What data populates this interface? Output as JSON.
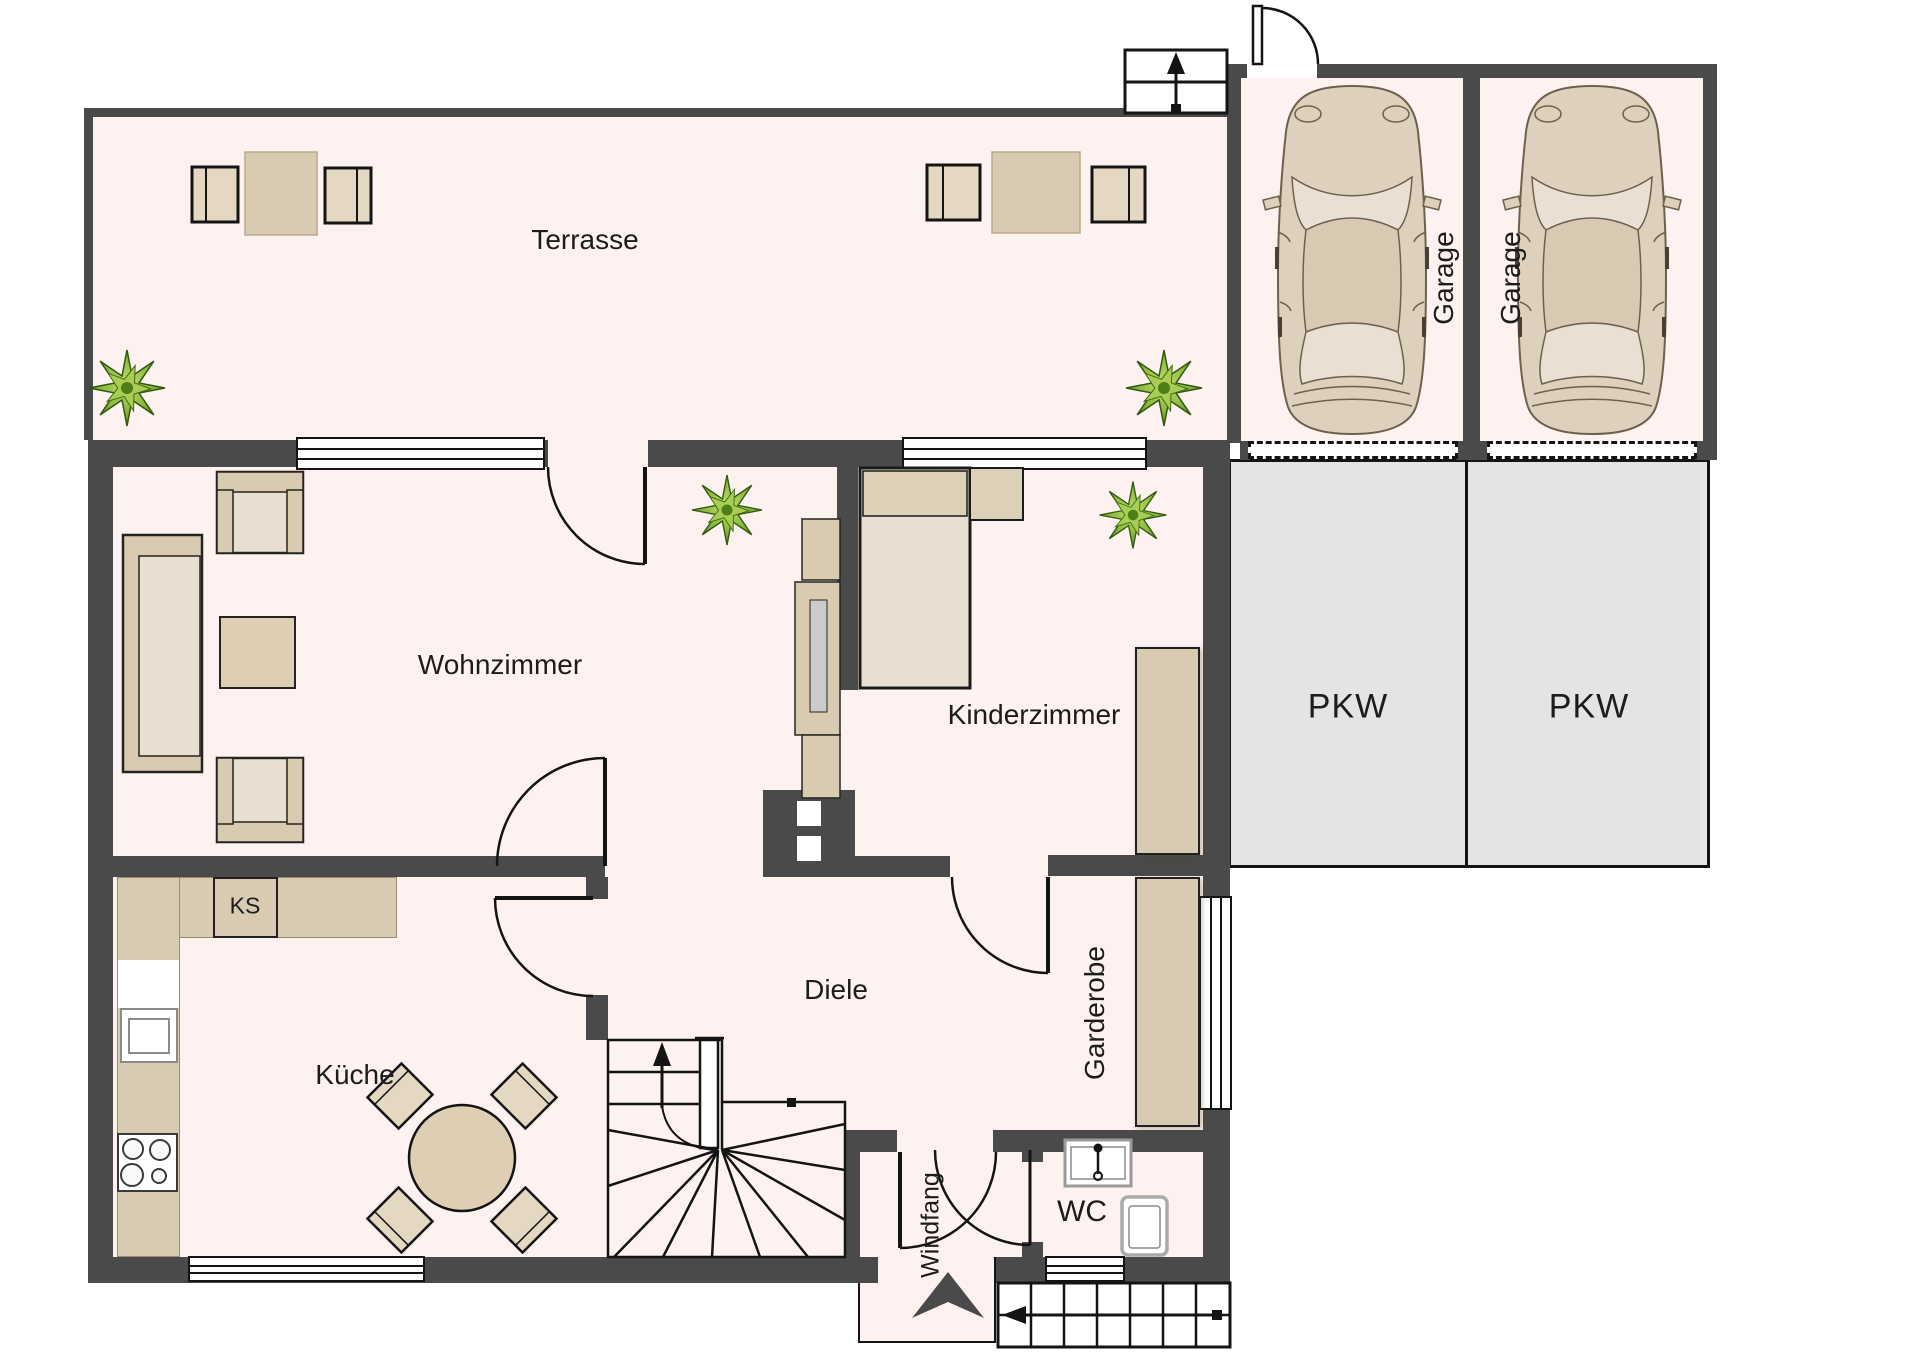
{
  "rooms": {
    "terrasse": "Terrasse",
    "wohnzimmer": "Wohnzimmer",
    "kinderzimmer": "Kinderzimmer",
    "kueche": "Küche",
    "diele": "Diele",
    "garderobe": "Garderobe",
    "windfang": "Windfang",
    "wc": "WC",
    "ks": "KS"
  },
  "garage": {
    "left": "Garage",
    "right": "Garage"
  },
  "parking": {
    "left": "PKW",
    "right": "PKW"
  },
  "icons": {
    "up_arrow_stairs": "arrow-up-icon",
    "entry_arrow": "entrance-arrow-icon"
  },
  "colors": {
    "wall": "#4a4a4a",
    "floor": "#fdf2ef",
    "furniture": "#d9cbb2",
    "furniture_light": "#e9dfd0",
    "parking_fill": "#e4e4e4",
    "plant_green": "#7fae33",
    "line": "#141414"
  }
}
